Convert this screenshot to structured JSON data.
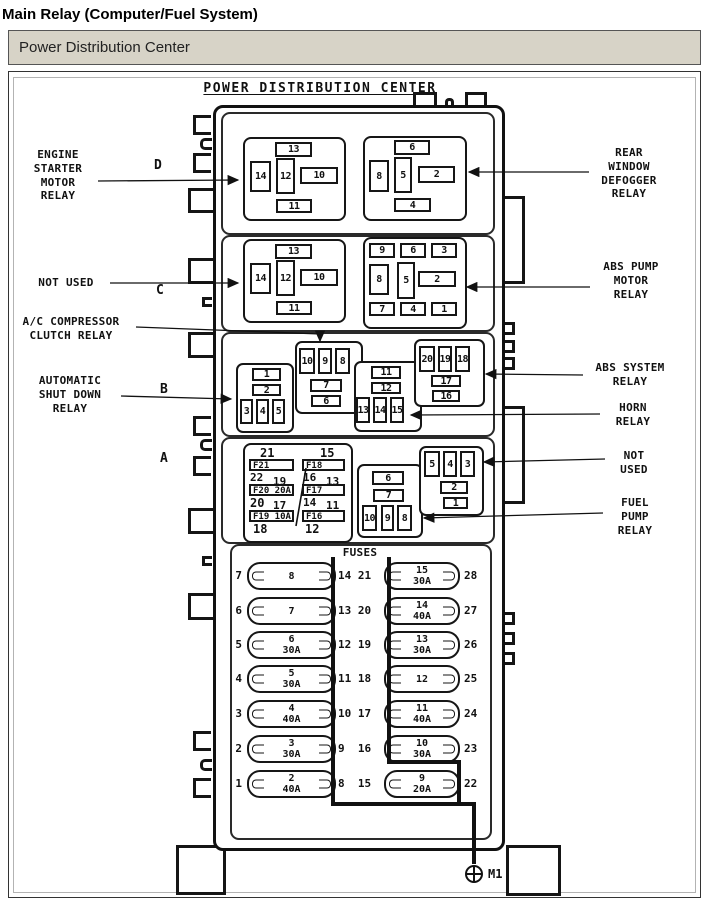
{
  "colors": {
    "header_bg": "#d7d3c7",
    "ink": "#111111"
  },
  "page": {
    "title": "Main Relay (Computer/Fuel System)",
    "header": "Power Distribution Center"
  },
  "pdc": {
    "title": "POWER DISTRIBUTION CENTER",
    "ground": "M1",
    "section_letters": {
      "d": "D",
      "c": "C",
      "b": "B",
      "a": "A"
    },
    "callouts": {
      "engine_starter": "ENGINE\nSTARTER\nMOTOR\nRELAY",
      "not_used_left": "NOT USED",
      "ac_compressor": "A/C COMPRESSOR\nCLUTCH RELAY",
      "auto_shutdown": "AUTOMATIC\nSHUT DOWN\nRELAY",
      "rear_defogger": "REAR\nWINDOW\nDEFOGGER\nRELAY",
      "abs_pump": "ABS PUMP\nMOTOR\nRELAY",
      "abs_system": "ABS SYSTEM\nRELAY",
      "horn": "HORN\nRELAY",
      "not_used_right": "NOT\nUSED",
      "fuel_pump": "FUEL\nPUMP\nRELAY"
    },
    "relays": {
      "d_left": [
        "13",
        "14",
        "12",
        "10",
        "11"
      ],
      "d_right": [
        "6",
        "8",
        "5",
        "2",
        "4"
      ],
      "c_left": [
        "13",
        "14",
        "12",
        "10",
        "11"
      ],
      "c_right": [
        "9",
        "6",
        "3",
        "8",
        "5",
        "2",
        "7",
        "4",
        "1"
      ],
      "asd": [
        "1",
        "2",
        "3",
        "4",
        "5"
      ],
      "ac": [
        "10",
        "9",
        "8",
        "7",
        "6"
      ],
      "horn": [
        "11",
        "12",
        "13",
        "14",
        "15"
      ],
      "abs_system": [
        "20",
        "19",
        "18",
        "17",
        "16"
      ],
      "fuel_pump": [
        "6",
        "7",
        "10",
        "9",
        "8"
      ],
      "not_used": [
        "5",
        "4",
        "3",
        "2",
        "1"
      ]
    },
    "fuse_block": {
      "col1": {
        "top": "21",
        "f1": "F21",
        "p1a": "22",
        "p1b": "19",
        "f2": "F20 20A",
        "p2a": "20",
        "p2b": "17",
        "f3": "F19 10A",
        "bottom": "18"
      },
      "col2": {
        "top": "15",
        "f1": "F18",
        "p1a": "16",
        "p1b": "13",
        "f2": "F17 10A",
        "p2a": "14",
        "p2b": "11",
        "f3": "F16 20A",
        "bottom": "12"
      }
    },
    "fuses": {
      "title": "FUSES",
      "rows": [
        {
          "slot": "7",
          "left": "8",
          "mid": "14 21",
          "right": "15\n30A",
          "out": "28"
        },
        {
          "slot": "6",
          "left": "7",
          "mid": "13 20",
          "right": "14\n40A",
          "out": "27"
        },
        {
          "slot": "5",
          "left": "6\n30A",
          "mid": "12 19",
          "right": "13\n30A",
          "out": "26"
        },
        {
          "slot": "4",
          "left": "5\n30A",
          "mid": "11 18",
          "right": "12",
          "out": "25"
        },
        {
          "slot": "3",
          "left": "4\n40A",
          "mid": "10 17",
          "right": "11\n40A",
          "out": "24"
        },
        {
          "slot": "2",
          "left": "3\n30A",
          "mid": "9  16",
          "right": "10\n30A",
          "out": "23"
        },
        {
          "slot": "1",
          "left": "2\n40A",
          "mid": "8  15",
          "right": "9\n20A",
          "out": "22"
        }
      ]
    }
  }
}
